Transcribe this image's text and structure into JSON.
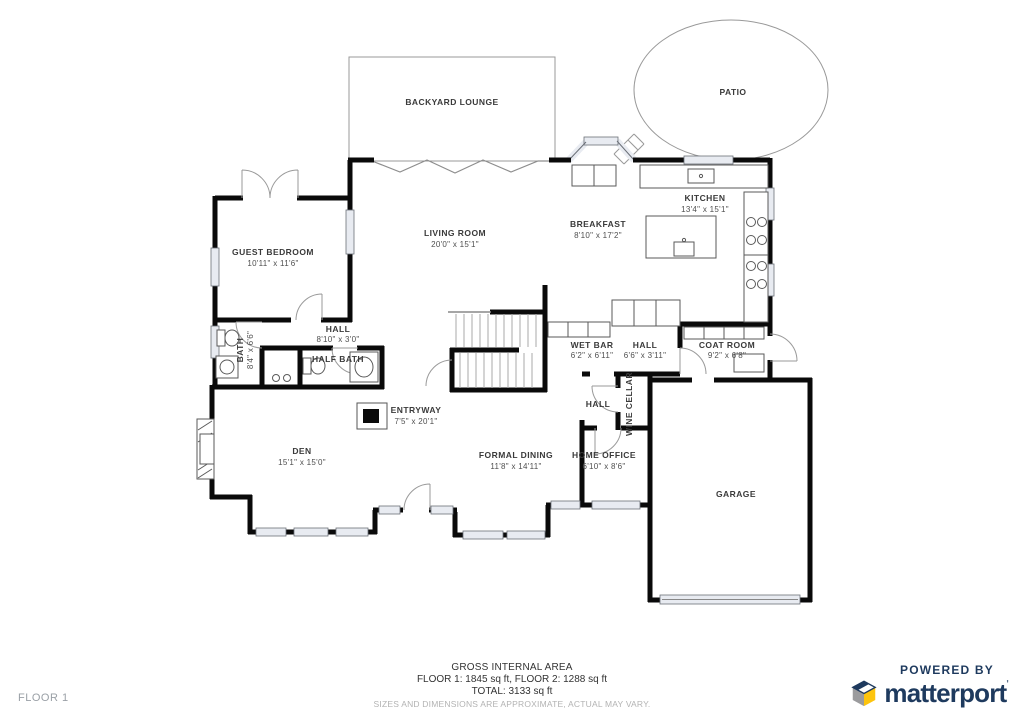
{
  "rooms": [
    {
      "name": "BACKYARD LOUNGE",
      "dims": ""
    },
    {
      "name": "PATIO",
      "dims": ""
    },
    {
      "name": "KITCHEN",
      "dims": "13'4\" x 15'1\""
    },
    {
      "name": "BREAKFAST",
      "dims": "8'10\" x 17'2\""
    },
    {
      "name": "LIVING ROOM",
      "dims": "20'0\" x 15'1\""
    },
    {
      "name": "GUEST BEDROOM",
      "dims": "10'11\" x 11'6\""
    },
    {
      "name": "HALL",
      "dims": "8'10\" x 3'0\""
    },
    {
      "name": "BATH",
      "dims": "8'4\" x 6'6\""
    },
    {
      "name": "HALF BATH",
      "dims": ""
    },
    {
      "name": "WET BAR",
      "dims": "6'2\" x 6'11\""
    },
    {
      "name": "HALL",
      "dims": "6'6\" x 3'11\""
    },
    {
      "name": "COAT ROOM",
      "dims": "9'2\" x 6'8\""
    },
    {
      "name": "HALL",
      "dims": ""
    },
    {
      "name": "WINE CELLAR",
      "dims": ""
    },
    {
      "name": "DEN",
      "dims": "15'1\" x 15'0\""
    },
    {
      "name": "ENTRYWAY",
      "dims": "7'5\" x 20'1\""
    },
    {
      "name": "FORMAL DINING",
      "dims": "11'8\" x 14'11\""
    },
    {
      "name": "HOME OFFICE",
      "dims": "6'10\" x 8'6\""
    },
    {
      "name": "GARAGE",
      "dims": ""
    }
  ],
  "footer": {
    "title": "GROSS INTERNAL AREA",
    "line1": "FLOOR 1: 1845 sq ft, FLOOR 2: 1288 sq ft",
    "line2": "TOTAL: 3133 sq ft",
    "disclaimer": "SIZES AND DIMENSIONS ARE APPROXIMATE, ACTUAL MAY VARY."
  },
  "floor_label": "FLOOR 1",
  "branding": {
    "powered_by": "POWERED BY",
    "brand": "matterport",
    "tm": "'",
    "navy": "#1e3a5e",
    "yellow": "#fdc40d",
    "gray": "#9b9b9d"
  }
}
